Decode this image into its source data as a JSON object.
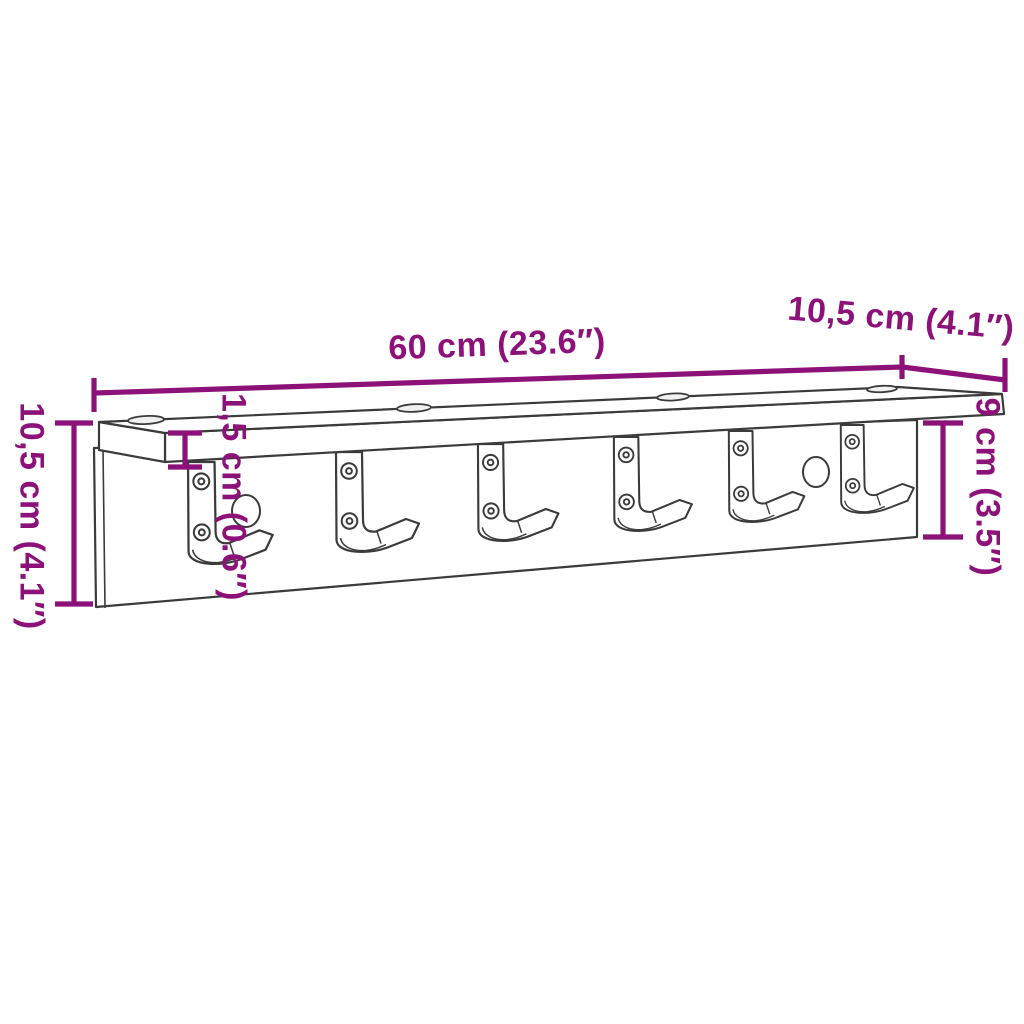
{
  "diagram": {
    "type": "product-dimension-diagram",
    "accent_color": "#8C1279",
    "line_color": "#3B3B3B",
    "background_color": "#FFFFFF",
    "dimensions": {
      "width": {
        "label": "60 cm (23.6″)",
        "value_cm": "60",
        "value_in": "23.6"
      },
      "depth": {
        "label": "10,5 cm (4.1″)",
        "value_cm": "10,5",
        "value_in": "4.1"
      },
      "height": {
        "label": "10,5 cm (4.1″)",
        "value_cm": "10,5",
        "value_in": "4.1"
      },
      "panel_height": {
        "label": "9 cm (3.5″)",
        "value_cm": "9",
        "value_in": "3.5"
      },
      "shelf_thickness": {
        "label": "1,5 cm (0.6″)",
        "value_cm": "1,5",
        "value_in": "0.6"
      }
    },
    "features": {
      "hook_count": 6,
      "screws_per_hook": 2,
      "top_slot_count": 4,
      "panel_hole_count": 2
    }
  }
}
